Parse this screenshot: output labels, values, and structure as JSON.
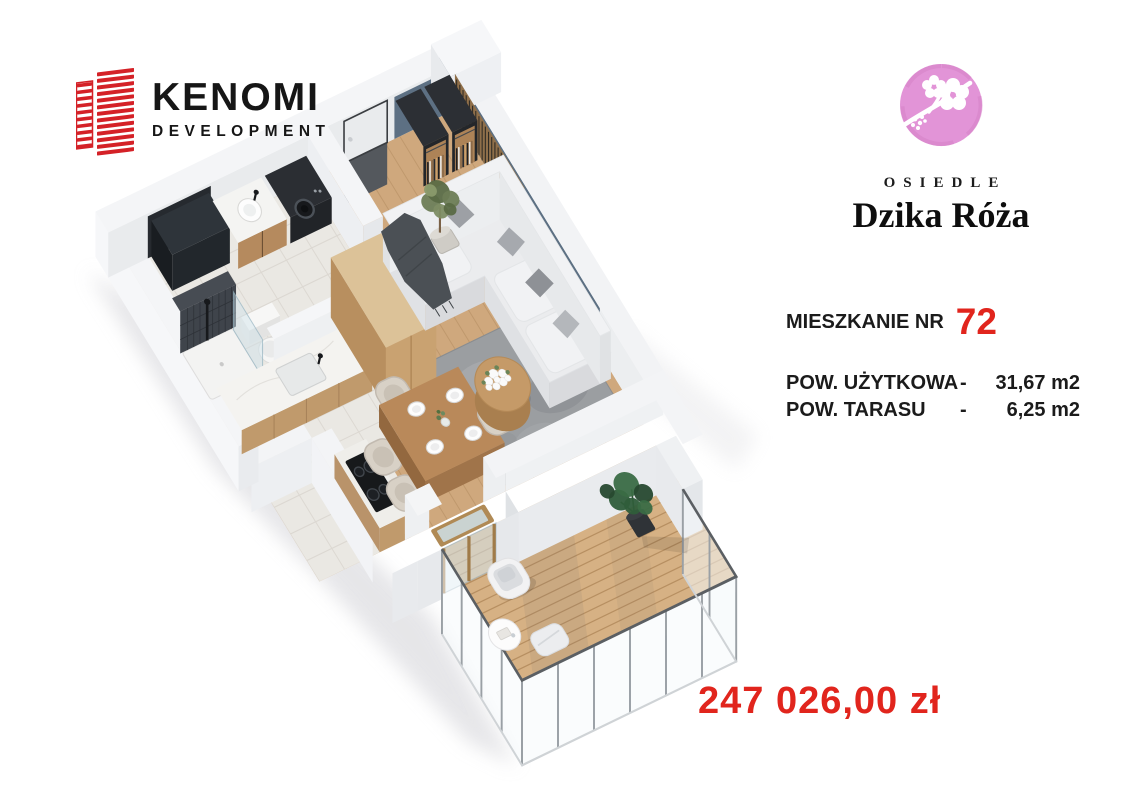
{
  "header": {
    "developer": {
      "name": "KENOMI",
      "subtitle": "DEVELOPMENT"
    },
    "estate": {
      "label": "OSIEDLE",
      "name": "Dzika Róża"
    }
  },
  "details": {
    "apartment_label": "MIESZKANIE NR",
    "apartment_number": "72",
    "areas": [
      {
        "label": "POW. UŻYTKOWA",
        "dash": "-",
        "value": "31,67 m2"
      },
      {
        "label": "POW. TARASU",
        "dash": "-",
        "value": "6,25 m2"
      }
    ],
    "price": "247 026,00 zł"
  },
  "icons": {
    "building_icon": "building-icon",
    "rose_icon": "rose-icon"
  },
  "colors": {
    "brand_red": "#d42127",
    "accent_red": "#e1251d",
    "logo_pink": "#e294d7",
    "wall_blue": "#5d7083",
    "wood_floor": "#cfa87d",
    "deck_wood": "#d6b184"
  }
}
